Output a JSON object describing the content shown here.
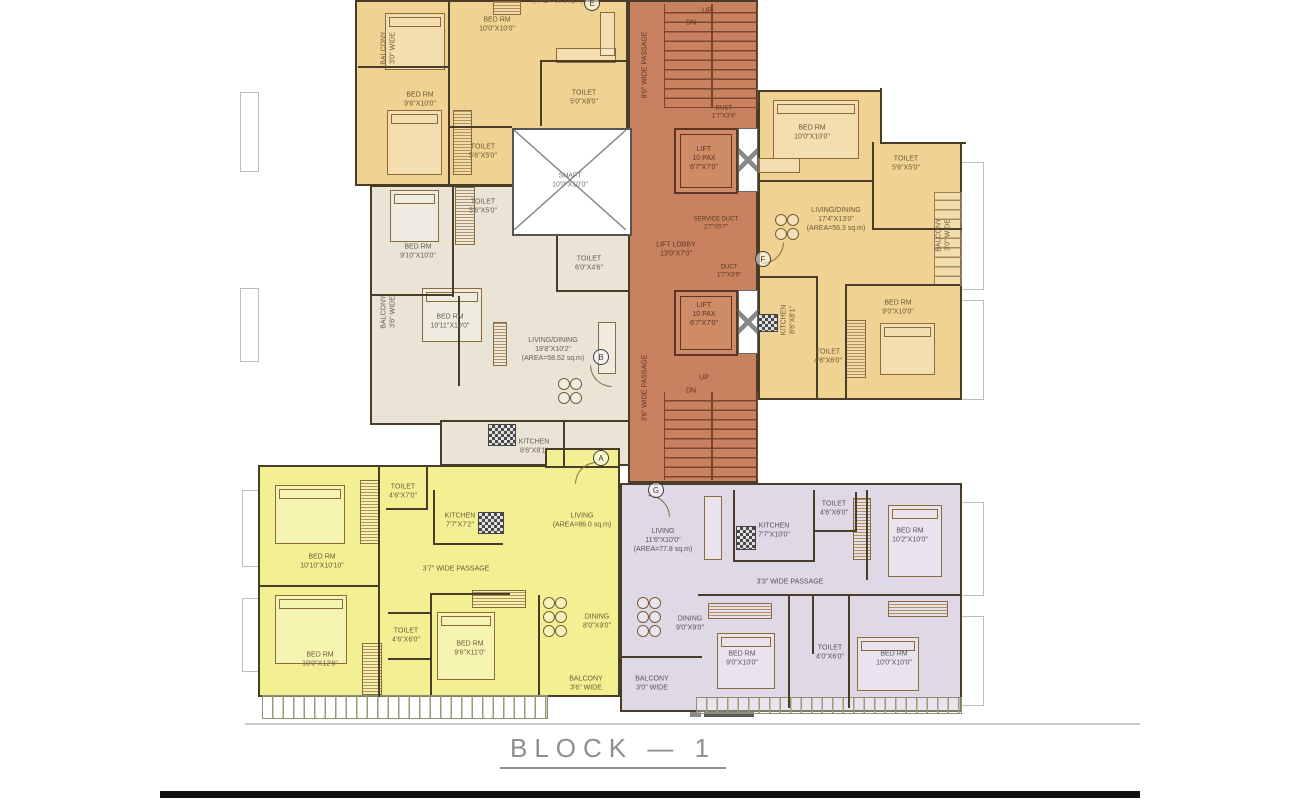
{
  "title": "BLOCK  —  1",
  "colors": {
    "unit_tan": "#f0d292",
    "unit_beige": "#e9e4d6",
    "unit_yellow": "#f3f094",
    "unit_purple": "#dfd9e7",
    "corridor": "#c9825f",
    "wall": "#4a3d27",
    "title_gray": "#8f8f8f"
  },
  "markers": {
    "a": "A",
    "b": "B",
    "e": "E",
    "f": "F",
    "g": "G"
  },
  "corridor": {
    "labels": [
      "UP",
      "DN",
      "8'0\" WIDE PASSAGE",
      "DUCT\n1'7\"X3'9\"",
      "LIFT\n10 PAX\n6'7\"X7'0\"",
      "SERVICE DUCT\n2'7\"X5'7\"",
      "LIFT LOBBY\n13'0\"X7'0\"",
      "DUCT\n1'7\"X3'9\"",
      "LIFT\n10 PAX\n6'7\"X7'0\"",
      "3'6\" WIDE PASSAGE",
      "UP",
      "DN"
    ]
  },
  "units": {
    "top_left": {
      "labels": [
        "BED RM\n10'0\"X10'0\"",
        "BALCONY\n3'0\" WIDE",
        "BED RM\n9'6\"X10'0\"",
        "TOILET\n5'0\"X8'0\"",
        "TOILET\n5'6\"X5'0\"",
        "SHAFT\n10'0\"X10'0\"",
        "(AREA=56.3 sq.m)"
      ]
    },
    "mid_left": {
      "labels": [
        "TOILET\n5'6\"X5'0\"",
        "BED RM\n9'10\"X10'0\"",
        "TOILET\n6'0\"X4'6\"",
        "BED RM\n10'11\"X10'0\"",
        "BALCONY\n3'6\" WIDE",
        "LIVING/DINING\n19'8\"X10'2\"\n(AREA=58.52 sq.m)",
        "KITCHEN\n8'6\"X8'1\""
      ]
    },
    "top_right": {
      "labels": [
        "BED RM\n10'0\"X10'0\"",
        "TOILET\n5'6\"X5'0\"",
        "LIVING/DINING\n17'4\"X13'0\"\n(AREA=56.3 sq.m)",
        "BALCONY\n3'0\" WIDE",
        "KITCHEN\n8'6\"X8'1\"",
        "BED RM\n9'0\"X10'0\"",
        "TOILET\n4'6\"X6'0\""
      ]
    },
    "bottom_left": {
      "labels": [
        "TOILET\n4'6\"X7'0\"",
        "KITCHEN\n7'7\"X7'2\"",
        "LIVING\n(AREA=86.0 sq.m)",
        "BED RM\n10'10\"X10'10\"",
        "3'7\" WIDE PASSAGE",
        "BED RM\n10'0\"X12'6\"",
        "TOILET\n4'6\"X6'0\"",
        "BED RM\n9'6\"X11'0\"",
        "DINING\n8'0\"X9'0\"",
        "BALCONY\n3'6\" WIDE"
      ]
    },
    "bottom_right": {
      "labels": [
        "LIVING\n11'6\"X10'0\"\n(AREA=77.8 sq.m)",
        "KITCHEN\n7'7\"X10'0\"",
        "TOILET\n4'6\"X6'0\"",
        "BED RM\n10'2\"X10'0\"",
        "3'3\" WIDE PASSAGE",
        "DINING\n9'0\"X9'0\"",
        "BED RM\n9'0\"X10'0\"",
        "TOILET\n4'0\"X6'0\"",
        "BED RM\n10'0\"X10'0\"",
        "BALCONY\n3'0\" WIDE"
      ]
    }
  }
}
